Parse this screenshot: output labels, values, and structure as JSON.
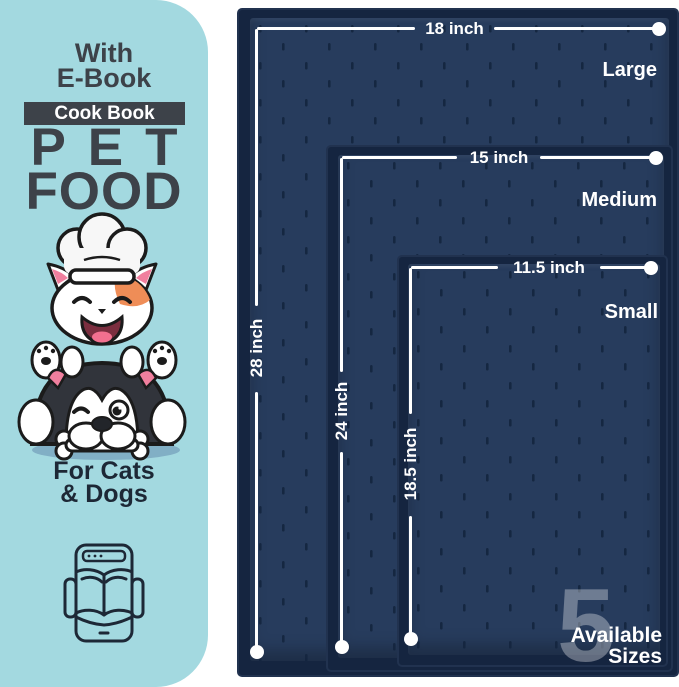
{
  "colors": {
    "sidebar_bg": "#a3d9e0",
    "text_charcoal": "#3d4249",
    "text_navy": "#1d2836",
    "mat_surface": "#273c5d",
    "mat_rim": "#152540",
    "measure_white": "#ffffff",
    "ghost_numeral": "rgba(255,255,255,0.33)",
    "cat_patch_orange": "#ef8d57",
    "ear_pink": "#f07f9e",
    "ground_shadow_blue": "#7ba7bf"
  },
  "sidebar": {
    "with_ebook": "With\nE-Book",
    "cookbook_badge": "Cook Book",
    "title_line1": "PET",
    "title_line2": "FOOD",
    "for_pets": "For Cats\n& Dogs",
    "illustration": "cat-chef-on-winking-husky-holding-bone",
    "ebook_icon": "tablet-open-book-icon"
  },
  "mats": [
    {
      "name": "Large",
      "width_label": "18 inch",
      "height_label": "28 inch"
    },
    {
      "name": "Medium",
      "width_label": "15 inch",
      "height_label": "24 inch"
    },
    {
      "name": "Small",
      "width_label": "11.5 inch",
      "height_label": "18.5 inch"
    }
  ],
  "badge": {
    "count": "5",
    "label": "Available\nSizes"
  }
}
